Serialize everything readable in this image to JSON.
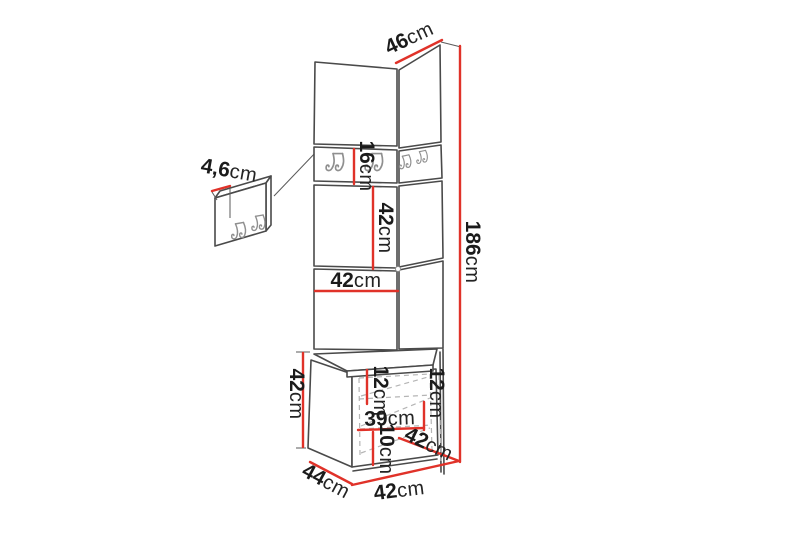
{
  "diagram": {
    "subject": "corner-hallway-panel-with-bench-dimension-diagram",
    "unit": "cm",
    "colors": {
      "dimension_line": "#e03229",
      "outline": "#4a4a4a",
      "hook": "#8f8f8f",
      "label_text": "#1b1b1b",
      "hidden_edge": "#b5b5b5",
      "background": "#ffffff"
    },
    "labels": {
      "panel_thickness": {
        "value": "4,6",
        "unit": "cm"
      },
      "side_depth_top": {
        "value": "46",
        "unit": "cm"
      },
      "total_height": {
        "value": "186",
        "unit": "cm"
      },
      "hook_strip_height": {
        "value": "16",
        "unit": "cm"
      },
      "middle_panel_height": {
        "value": "42",
        "unit": "cm"
      },
      "panel_width": {
        "value": "42",
        "unit": "cm"
      },
      "bench_height": {
        "value": "42",
        "unit": "cm"
      },
      "top_compartment_height_left": {
        "value": "12",
        "unit": "cm"
      },
      "top_compartment_height_right": {
        "value": "12",
        "unit": "cm"
      },
      "compartment_width": {
        "value": "39",
        "unit": "cm"
      },
      "bottom_compartment_height": {
        "value": "10",
        "unit": "cm"
      },
      "bench_depth_top": {
        "value": "42",
        "unit": "cm"
      },
      "bench_depth_side": {
        "value": "44",
        "unit": "cm"
      },
      "bench_width": {
        "value": "42",
        "unit": "cm"
      }
    }
  }
}
